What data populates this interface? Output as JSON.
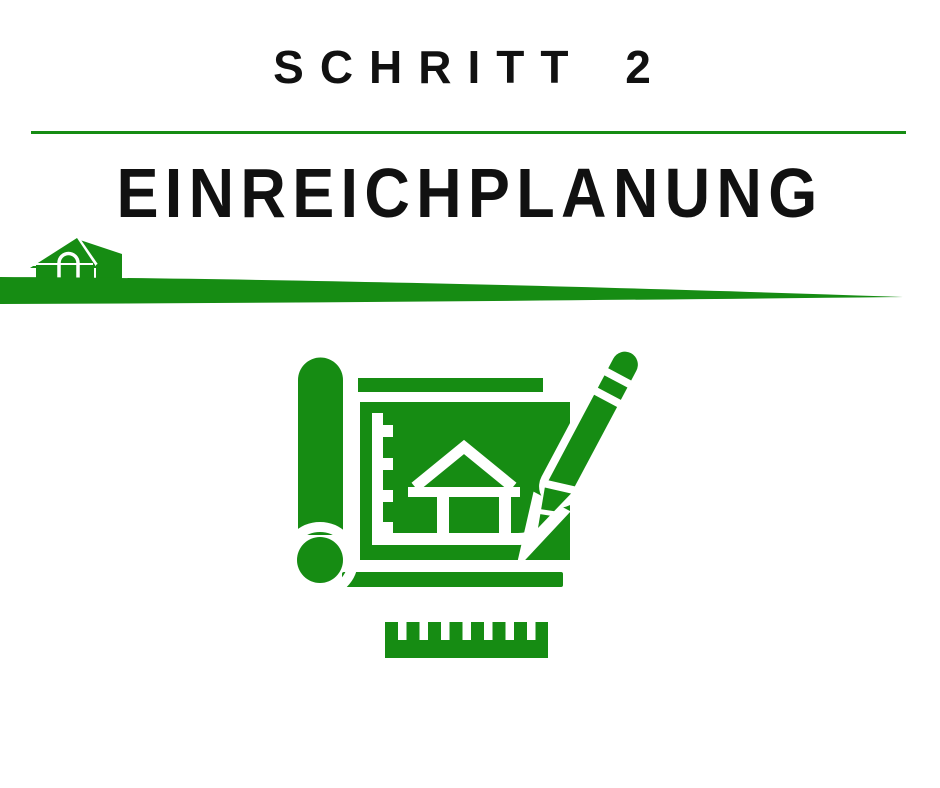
{
  "header": {
    "step_label": "SCHRITT 2",
    "title": "EINREICHPLANUNG"
  },
  "colors": {
    "accent_green": "#168c13",
    "text_black": "#111111",
    "background": "#ffffff"
  },
  "graphics": {
    "divider_name": "green-divider-line",
    "hill_name": "hill-swoosh-graphic",
    "house_name": "house-icon",
    "blueprint_name": "blueprint-pencil-icon",
    "ruler_name": "ruler-icon"
  }
}
